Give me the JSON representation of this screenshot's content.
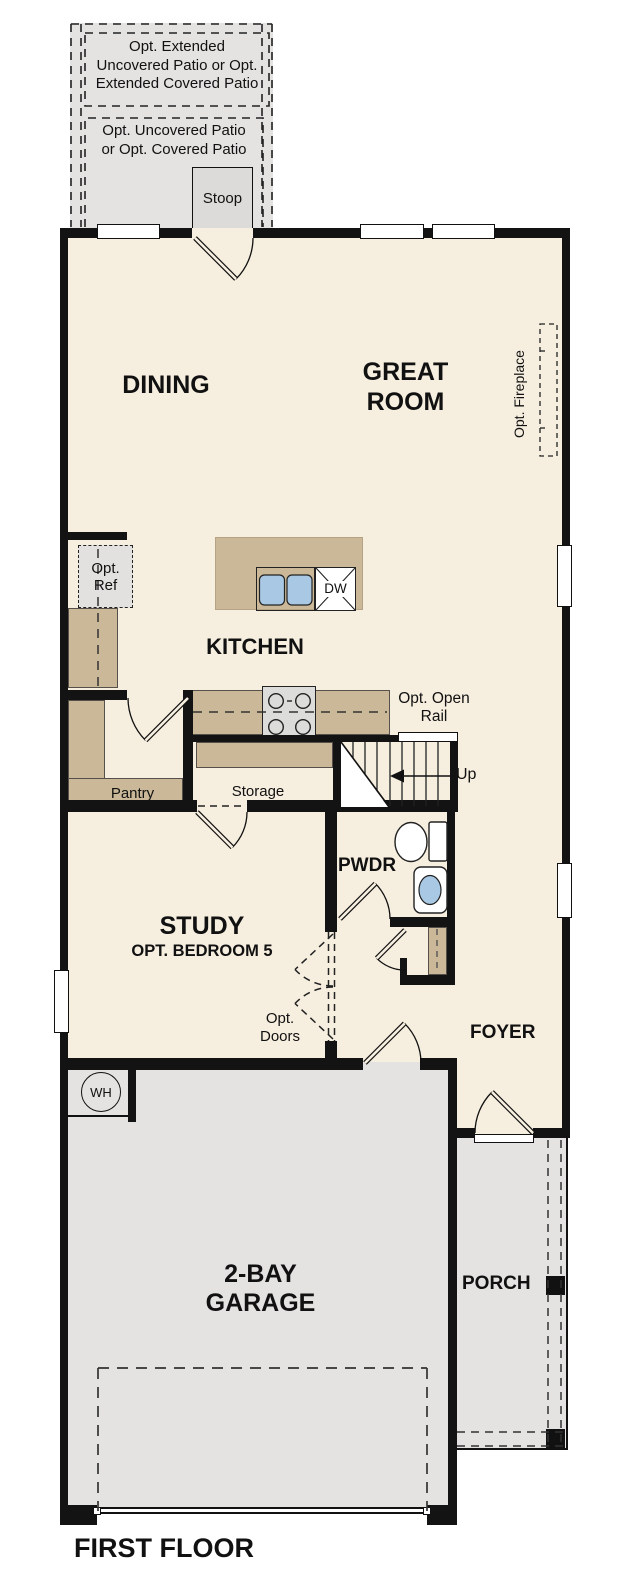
{
  "title": "FIRST FLOOR",
  "rooms": {
    "dining": "DINING",
    "great_room": [
      "GREAT",
      "ROOM"
    ],
    "kitchen": "KITCHEN",
    "pantry": "Pantry",
    "storage": "Storage",
    "powder": "PWDR",
    "study": "STUDY",
    "study_option": "OPT. BEDROOM 5",
    "foyer": "FOYER",
    "garage": [
      "2-BAY",
      "GARAGE"
    ],
    "porch": "PORCH",
    "stoop": "Stoop"
  },
  "options": {
    "extended_patio": [
      "Opt. Extended",
      "Uncovered Patio or Opt.",
      "Extended Covered Patio"
    ],
    "patio": [
      "Opt. Uncovered Patio",
      "or Opt. Covered Patio"
    ],
    "refrigerator": [
      "Opt.",
      "Ref"
    ],
    "fireplace": "Opt. Fireplace",
    "open_rail": [
      "Opt. Open",
      "Rail"
    ],
    "doors": [
      "Opt.",
      "Doors"
    ]
  },
  "fixtures": {
    "dishwasher": "DW",
    "water_heater": "WH",
    "stairs_direction": "Up"
  },
  "colors": {
    "floor": "#f6eedf",
    "garage_porch_patio": "#e4e3e1",
    "counters": "#cab899",
    "walls": "#131313",
    "sink_basin": "#a9c8e4",
    "appliance": "#dcdcda"
  }
}
